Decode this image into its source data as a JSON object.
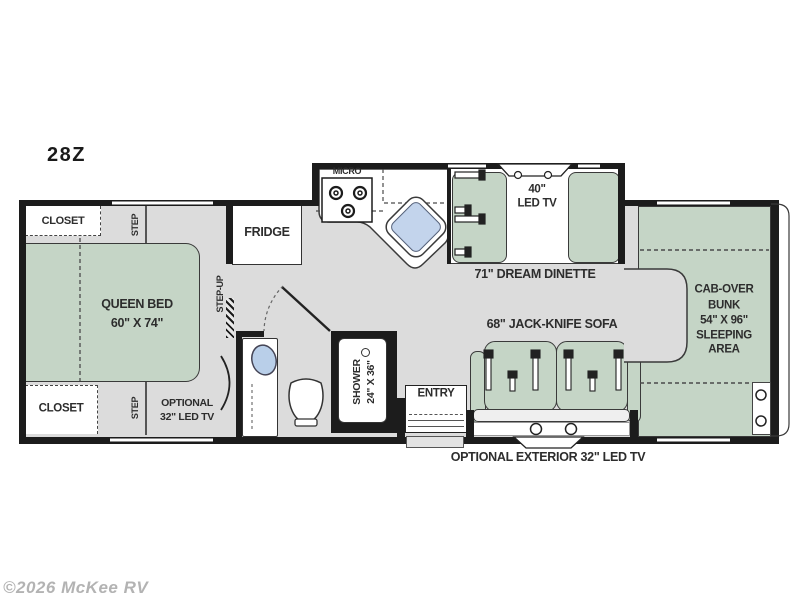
{
  "title": {
    "model": "28Z"
  },
  "watermark": "©2026 McKee RV",
  "colors": {
    "wall": "#1c1c1c",
    "floor_gray": "#dcdcdc",
    "furniture_green": "#c5d5c6",
    "sink_blue": "#c3d4ec",
    "white": "#ffffff",
    "label_text": "#2d2d2d",
    "watermark_gray": "#b3b3b3"
  },
  "rooms": {
    "closet_top": "CLOSET",
    "closet_bottom": "CLOSET",
    "step_top": "STEP",
    "step_bottom": "STEP",
    "step_up": "STEP-UP",
    "queen_bed": {
      "line1": "QUEEN BED",
      "line2": "60\" X 74\""
    },
    "optional_tv": {
      "line1": "OPTIONAL",
      "line2": "32\" LED TV"
    },
    "fridge": "FRIDGE",
    "micro": "MICRO",
    "tv40": {
      "line1": "40\"",
      "line2": "LED TV"
    },
    "dinette": "71\" DREAM DINETTE",
    "shower": {
      "line1": "SHOWER",
      "line2": "24\" X 36\""
    },
    "entry": "ENTRY",
    "sofa": "68\" JACK-KNIFE SOFA",
    "bunk": {
      "line1": "CAB-OVER",
      "line2": "BUNK",
      "line3": "54\" X 96\"",
      "line4": "SLEEPING",
      "line5": "AREA"
    },
    "exterior_tv": "OPTIONAL EXTERIOR 32\" LED TV"
  }
}
